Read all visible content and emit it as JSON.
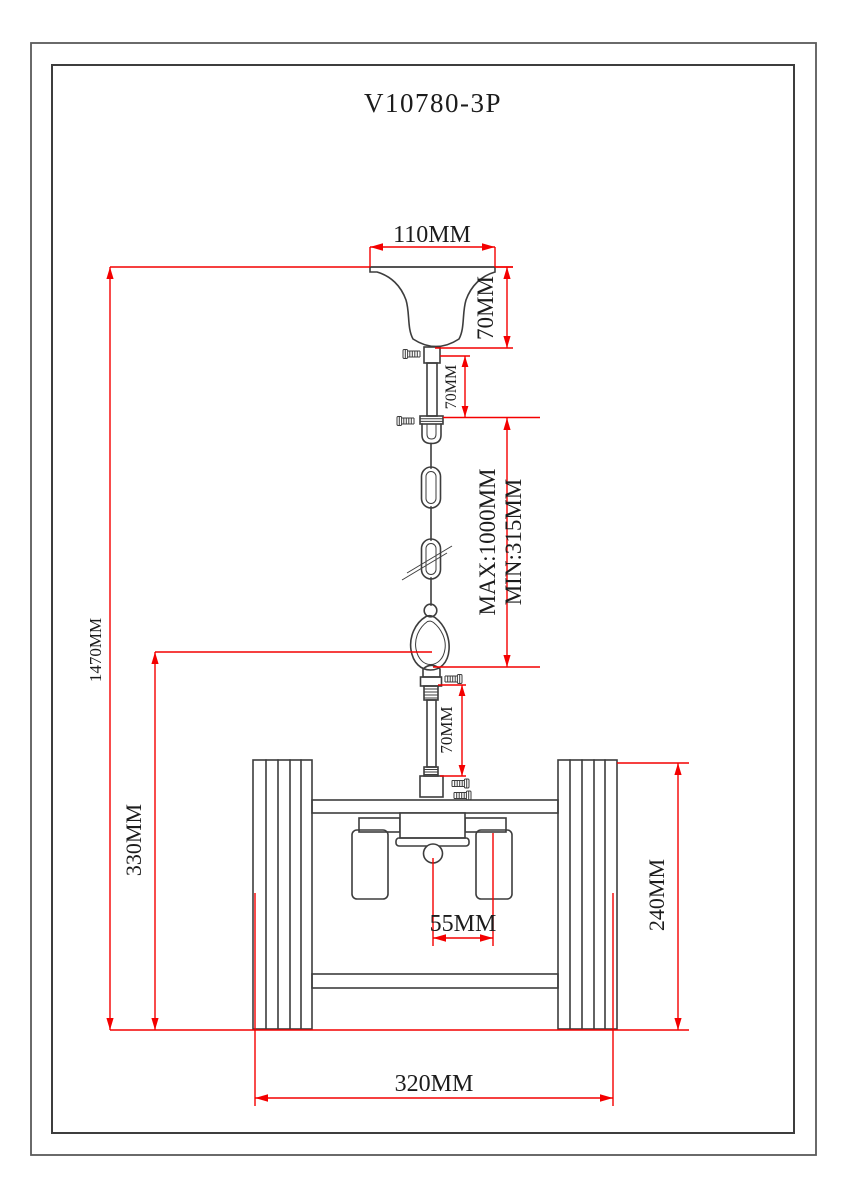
{
  "drawing": {
    "title": "V10780-3P",
    "colors": {
      "line": "#3d3d3d",
      "dimension": "#f40000",
      "border": "#5a5a5a",
      "background": "#ffffff"
    },
    "dimensions": {
      "canopy_width": "110MM",
      "canopy_height": "70MM",
      "upper_rod_length": "70MM",
      "chain_max": "MAX:1000MM",
      "chain_min": "MIN:315MM",
      "overall_height": "1470MM",
      "lower_rod_length": "70MM",
      "body_drop_height": "330MM",
      "shade_center_offset": "55MM",
      "side_panel_height": "240MM",
      "body_width": "320MM"
    }
  }
}
